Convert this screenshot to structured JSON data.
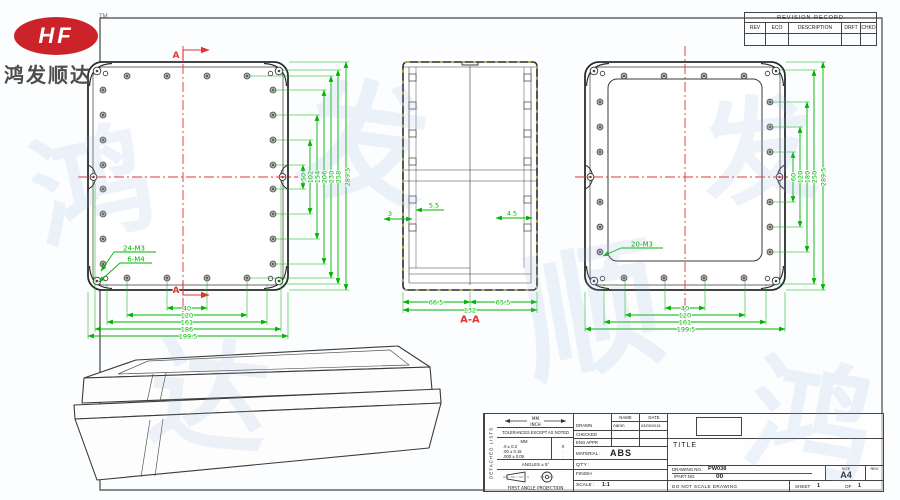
{
  "logo": {
    "brand": "HF",
    "tm": "TM",
    "company": "鸿发顺达"
  },
  "revision_table": {
    "title": "REVISION RECORD",
    "columns": [
      "REV",
      "ECO",
      "DESCRIPTION",
      "DRFT",
      "CHKD"
    ]
  },
  "views": {
    "left": {
      "section_label_top": "A",
      "section_label_bottom": "A",
      "holes_label_m3": "24-M3",
      "holes_label_m4": "6-M4",
      "dims_bottom": [
        "40",
        "120",
        "161",
        "186",
        "199.5"
      ],
      "dims_side": [
        "50",
        "102",
        "154",
        "206",
        "230",
        "258",
        "289.5"
      ]
    },
    "section": {
      "label": "A-A",
      "dim_wall_left": "3",
      "dim_boss": "5.5",
      "dim_wall_right": "4.5",
      "dims_bottom": [
        "66.5",
        "65.5",
        "132"
      ]
    },
    "right": {
      "holes_label": "20-M3",
      "dims_bottom": [
        "40",
        "120",
        "161",
        "199.5"
      ],
      "dims_side": [
        "60",
        "120",
        "180",
        "250",
        "289.5"
      ]
    }
  },
  "title_block": {
    "side_label": "DETACHED LISTS",
    "units_top": "MM",
    "units_bottom": "INCH",
    "tolerance_note": "TOLERANCES EXCEPT AS NOTED",
    "tol_header": "MM",
    "tol_rows": [
      ".0 ± 0.3",
      ".00 ± 0.15",
      ".000 ± 0.05"
    ],
    "tol_marks": [
      "X",
      "·",
      "·"
    ],
    "angles": "ANGLES ± 5°",
    "projection": "FIRST ANGLE PROJECTION",
    "name_header": "NAME",
    "date_header": "DATE",
    "drawn_label": "DRAWN",
    "drawn_name": "Aaron",
    "drawn_date": "03/05/2015",
    "checked_label": "CHECKED",
    "eng_appr_label": "ENG APPR",
    "material_label": "MATERIAL :",
    "material_value": "ABS",
    "qty_label": "QT'Y :",
    "finish_label": "FINISH",
    "scale_label": "SCALE :",
    "scale_value": "1:1",
    "title_label": "TITLE",
    "drawing_no_label": "DRAWING NO.",
    "drawing_no": "PW038",
    "part_no_label": "/PART NO.",
    "part_no": "00",
    "size_label": "SIZE",
    "size_value": "A4",
    "rev_label": "REV",
    "do_not_scale": "DO NOT SCALE DRAWING",
    "sheet_label": "SHEET",
    "sheet_value": "1",
    "of_label": "OF",
    "of_value": "1"
  },
  "colors": {
    "dimension_green": "#00b400",
    "centerline_red": "#e03434",
    "drawing_line": "#2b2b2b",
    "logo_red": "#cc2229"
  },
  "watermark_chars": [
    "鸿",
    "发",
    "顺",
    "达"
  ]
}
